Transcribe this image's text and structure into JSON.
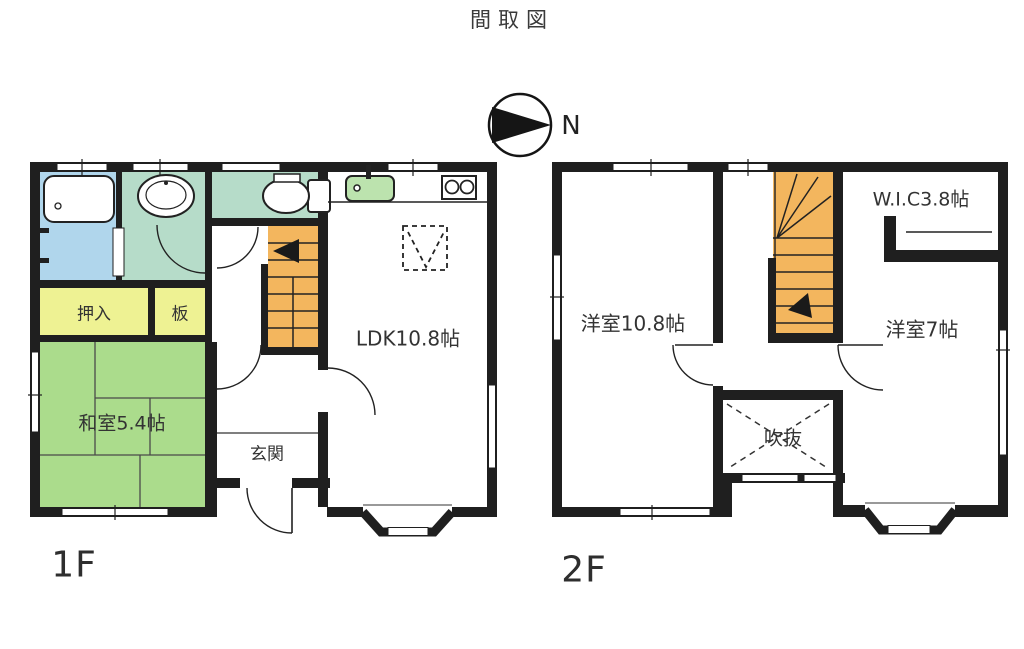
{
  "title": "間取図",
  "compass": {
    "north_label": "N"
  },
  "floor1": {
    "label": "1F",
    "rooms": {
      "oshiire": {
        "label": "押入"
      },
      "ita": {
        "label": "板"
      },
      "washitsu": {
        "label": "和室5.4帖"
      },
      "ldk": {
        "label": "LDK10.8帖"
      },
      "genkan": {
        "label": "玄関"
      }
    }
  },
  "floor2": {
    "label": "2F",
    "rooms": {
      "western_large": {
        "label": "洋室10.8帖"
      },
      "wic": {
        "label": "W.I.C3.8帖"
      },
      "western_small": {
        "label": "洋室7帖"
      },
      "fukinuke": {
        "label": "吹抜"
      }
    }
  },
  "colors": {
    "wall": "#1f1f1f",
    "bath_floor": "#b0d6ec",
    "wet_room": "#b6dcc9",
    "storage_yellow": "#eef293",
    "tatami_green": "#abdc8c",
    "stairs_orange": "#f3b65e",
    "sink_green": "#bce3ae"
  }
}
